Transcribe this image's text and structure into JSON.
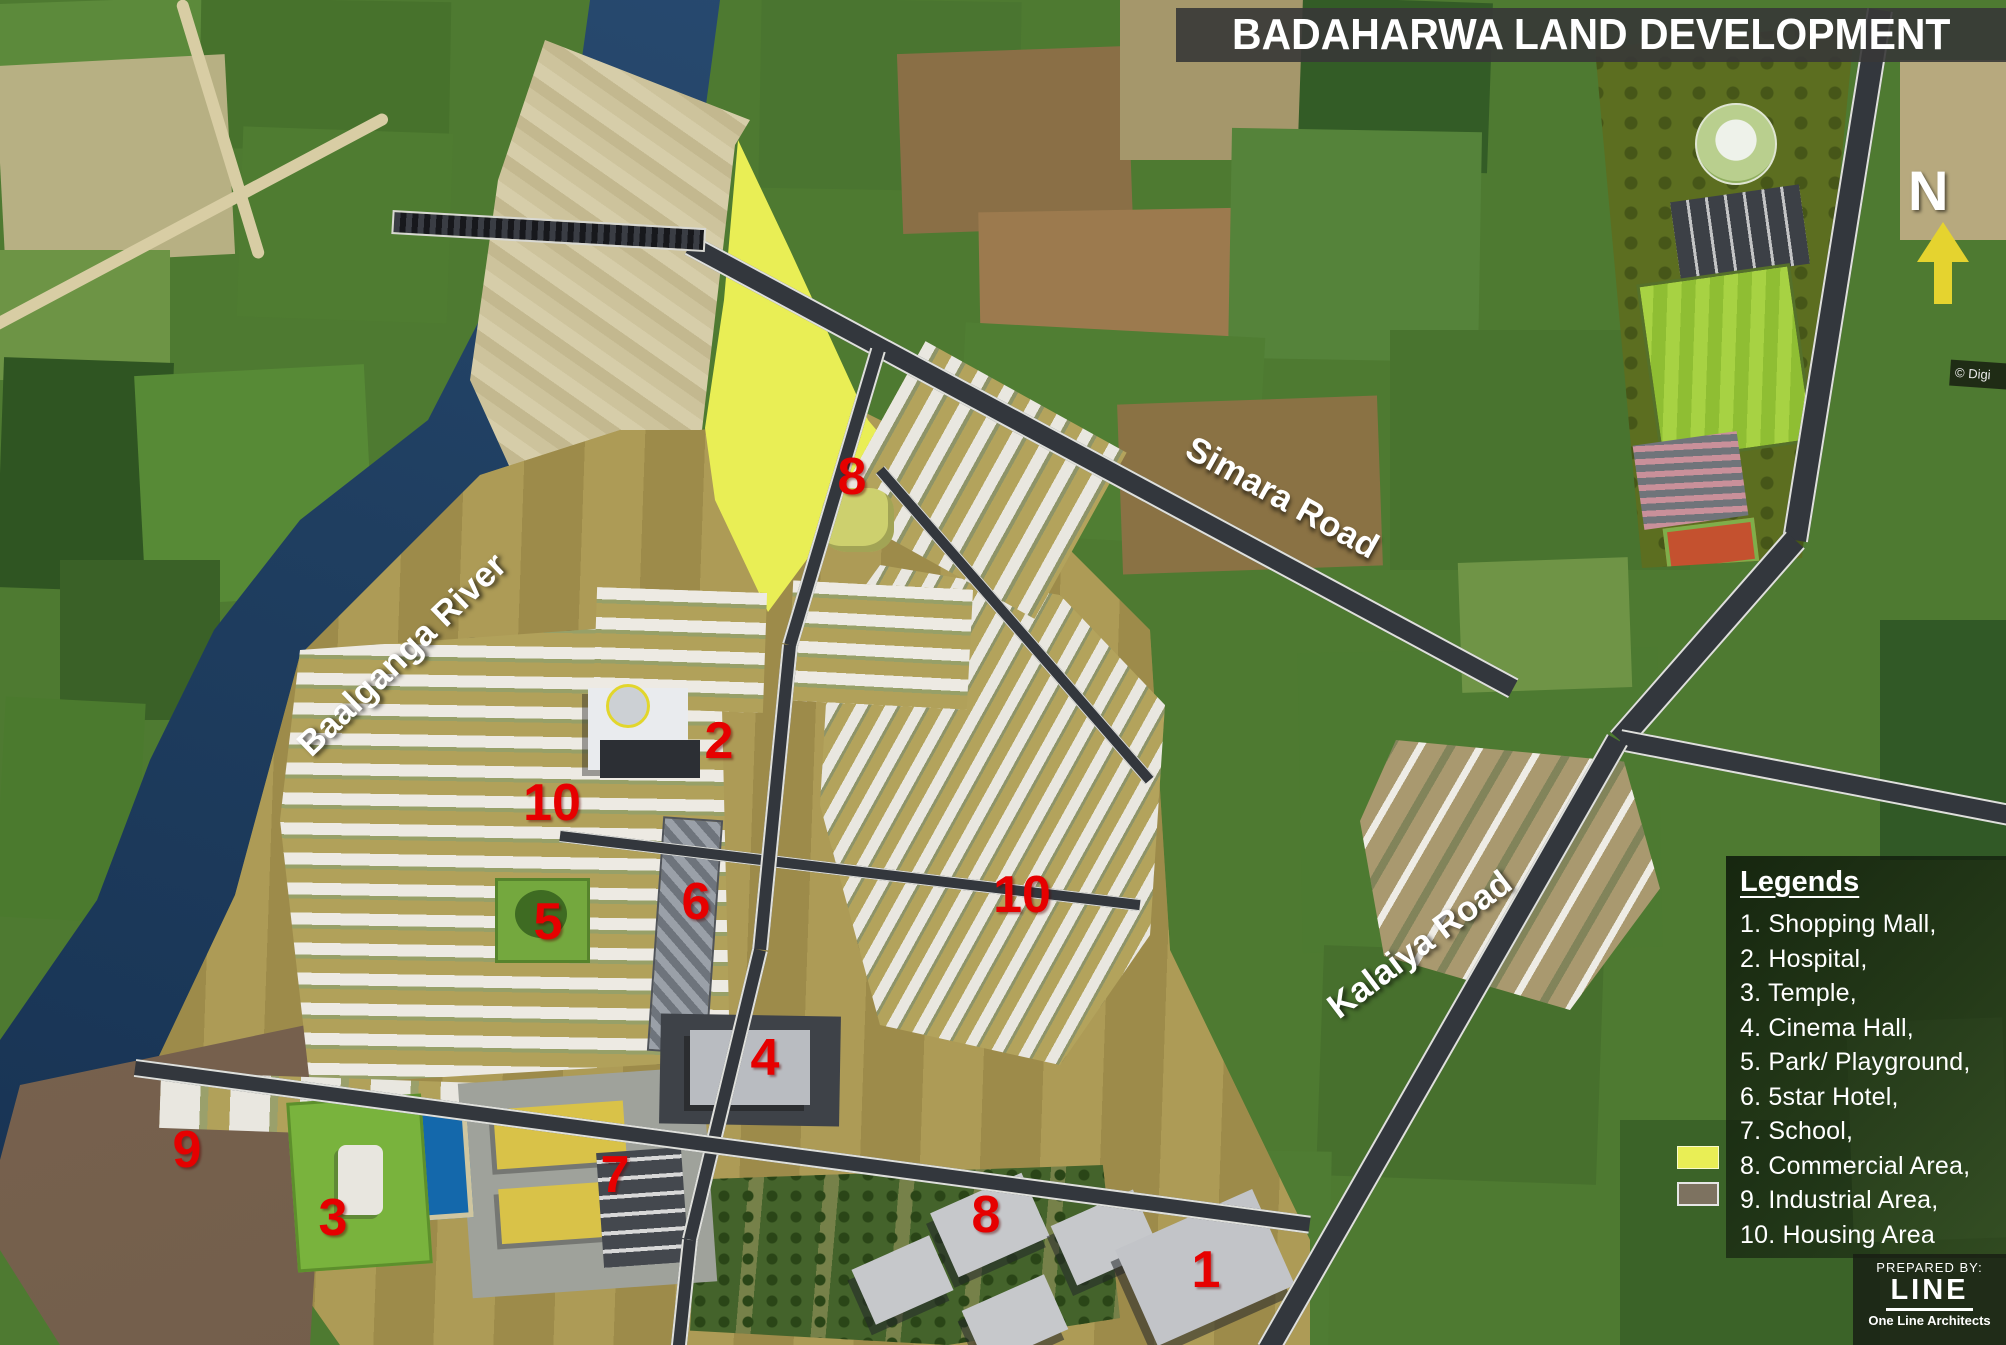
{
  "title": "BADAHARWA LAND DEVELOPMENT",
  "north": {
    "label": "N",
    "arrow_color": "#e5d32f"
  },
  "labels": {
    "simara_road": "Simara Road",
    "kalaiya_road": "Kalaiya Road",
    "river": "Baalganga River"
  },
  "markers": [
    {
      "label": "1",
      "name": "shopping-mall"
    },
    {
      "label": "2",
      "name": "hospital"
    },
    {
      "label": "3",
      "name": "temple"
    },
    {
      "label": "4",
      "name": "cinema-hall"
    },
    {
      "label": "5",
      "name": "park-playground"
    },
    {
      "label": "6",
      "name": "five-star-hotel"
    },
    {
      "label": "7",
      "name": "school"
    },
    {
      "label": "8",
      "name": "commercial-area-north"
    },
    {
      "label": "8",
      "name": "commercial-area-south"
    },
    {
      "label": "9",
      "name": "industrial-area"
    },
    {
      "label": "10",
      "name": "housing-area-west"
    },
    {
      "label": "10",
      "name": "housing-area-east"
    }
  ],
  "marker_color": "#e60000",
  "legend": {
    "heading": "Legends",
    "items": [
      "1. Shopping Mall,",
      "2. Hospital,",
      "3. Temple,",
      "4. Cinema Hall,",
      "5. Park/ Playground,",
      "6. 5star Hotel,",
      "7. School,",
      "8. Commercial Area,",
      "9. Industrial Area,",
      "10. Housing Area"
    ],
    "swatches": {
      "commercial": "#e9ee55",
      "industrial": "#7d7260"
    }
  },
  "prepared_by": {
    "caption": "PREPARED BY:",
    "logo": "LINE",
    "name": "One Line Architects"
  },
  "watermark": "© Digi",
  "zone_colors": {
    "commercial_area": "#e9ee55",
    "river": "#1f3e60",
    "development_ground": "#a4914f",
    "road": "#33373d"
  }
}
